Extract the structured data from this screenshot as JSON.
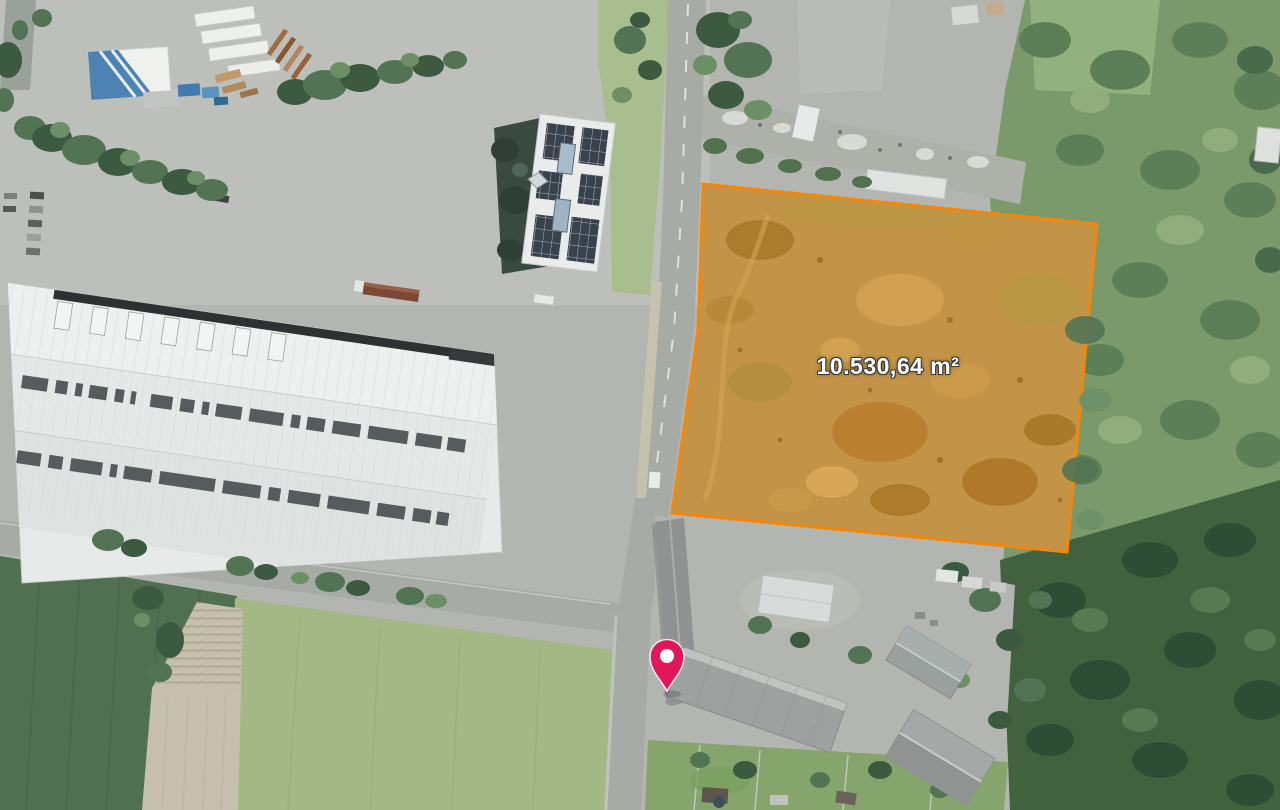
{
  "map": {
    "parcel": {
      "area_label": "10.530,64 m²",
      "outline_color": "#F2870D",
      "fill_color": "#EE8A0A"
    },
    "marker": {
      "icon": "location-pin",
      "pin_color": "#E2175B",
      "pin_hole_color": "#FFFFFF"
    }
  }
}
